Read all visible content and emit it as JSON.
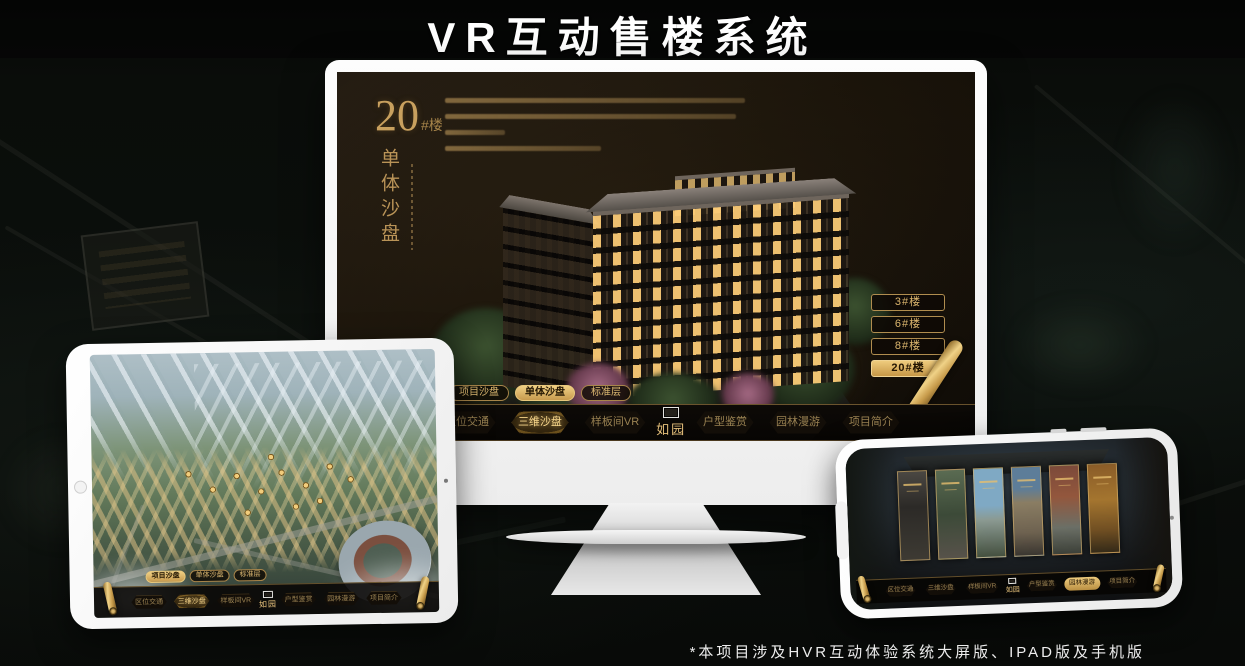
{
  "page": {
    "title": "VR互动售楼系统",
    "footnote": "*本项目涉及HVR互动体验系统大屏版、IPAD版及手机版"
  },
  "colors": {
    "gold": "#c9a063",
    "gold_bright": "#ecc87e",
    "screen_bg": "#171208",
    "nav_bg": "#0b0906"
  },
  "logo": {
    "text": "如园"
  },
  "nav_items": [
    "区位交通",
    "三维沙盘",
    "样板间VR",
    "户型鉴赏",
    "园林漫游",
    "项目简介"
  ],
  "subtabs": [
    "项目沙盘",
    "单体沙盘",
    "标准层"
  ],
  "monitor": {
    "building_no": "20",
    "building_suffix": "#楼",
    "mode_vertical": "单体沙盘",
    "floors": [
      "3#楼",
      "6#楼",
      "8#楼",
      "20#楼"
    ],
    "active_floor": "20#楼",
    "active_subtab": "单体沙盘",
    "active_nav": "三维沙盘"
  },
  "tablet": {
    "active_subtab": "项目沙盘",
    "active_nav": "三维沙盘"
  },
  "phone": {
    "active_nav": "园林漫游"
  }
}
